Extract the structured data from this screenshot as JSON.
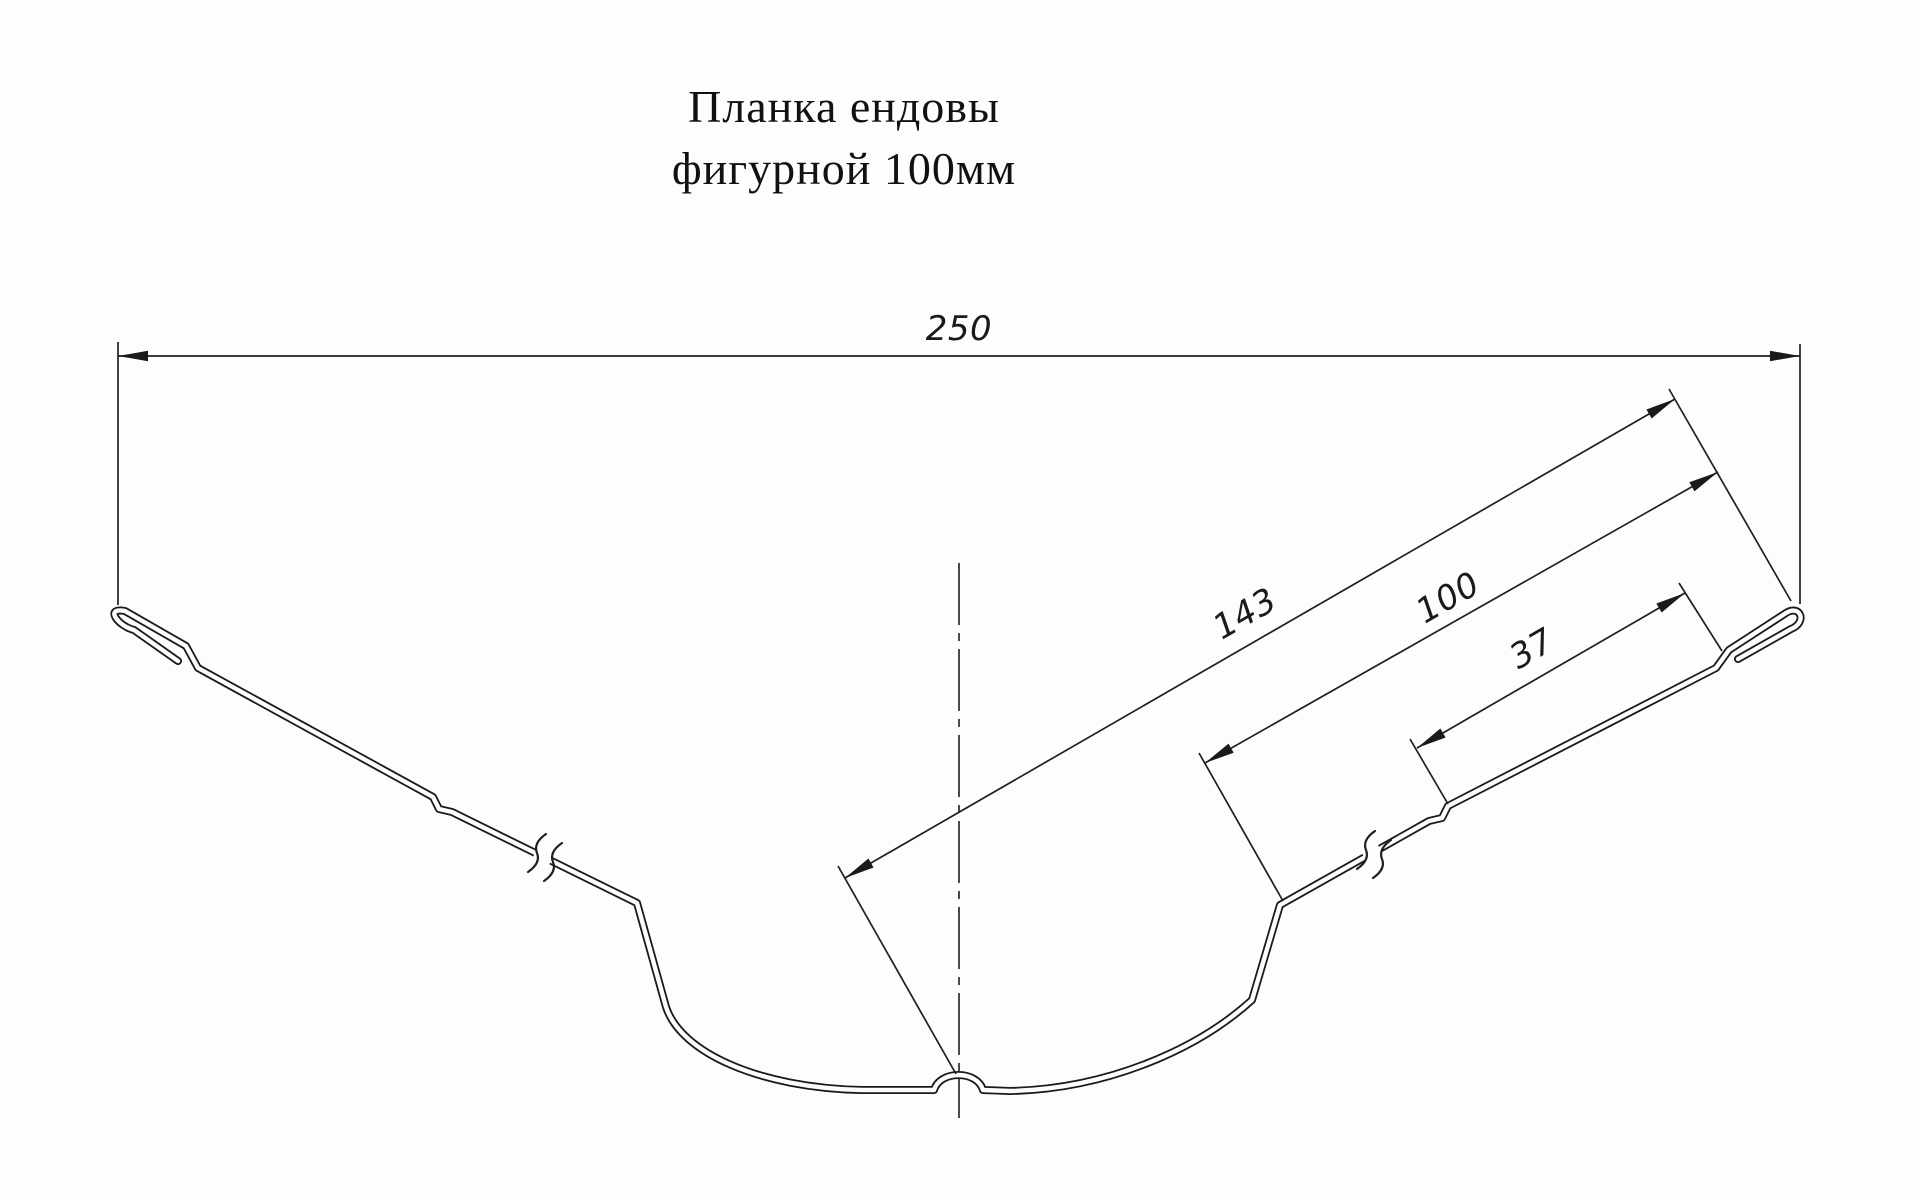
{
  "title": {
    "line1": "Планка ендовы",
    "line2": "фигурной 100мм"
  },
  "dimensions": {
    "overall_width": "250",
    "valley_slope": "143",
    "upper_section": "100",
    "edge_section": "37"
  },
  "colors": {
    "line": "#1a1a1a",
    "background": "#fdfdfd"
  },
  "drawing_type": "profile-cross-section"
}
